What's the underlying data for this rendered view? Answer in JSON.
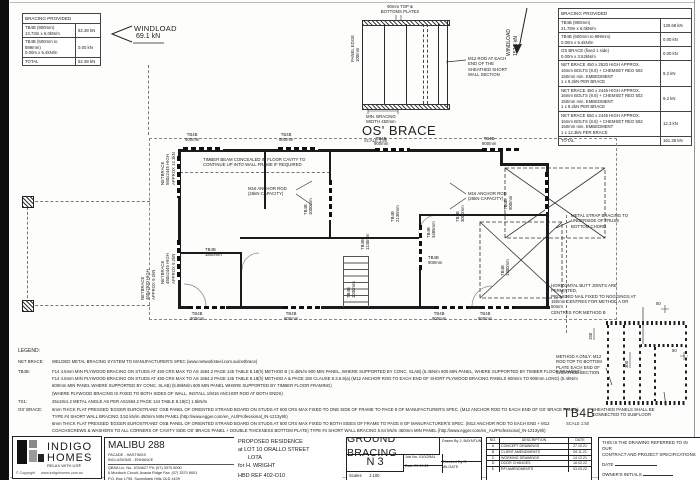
{
  "sheet": {
    "windload_left": {
      "label": "WINDLOAD",
      "value": "69.1 kN"
    },
    "windload_right": {
      "label": "WINDLOAD",
      "value": "157.3 kN"
    }
  },
  "table_left": {
    "header": "BRACING PROVIDED",
    "rows": [
      {
        "desc": "TB4B (900mm)\n13.73m x 6.0kN/m",
        "value": "82.38 kN"
      },
      {
        "desc": "TB4B (600mm to 899mm)\n0.00m x 5.4kN/m",
        "value": "0.00 kN"
      }
    ],
    "total_label": "TOTAL",
    "total_value": "82.38 kN"
  },
  "table_right": {
    "header": "BRACING PROVIDED",
    "rows": [
      {
        "desc": "TB4B (900mm)\n21.78m x 6.0kN/m",
        "value": "130.68 kN"
      },
      {
        "desc": "TB4B (600mm to 899mm)\n0.00m x 5.4kN/m",
        "value": "0.00 kN"
      },
      {
        "desc": "OS BRACE (fixed 1 side)\n0.00m x 3.52kN/m",
        "value": "0.00 kN"
      },
      {
        "desc": "NET BRACE 450 x 2520 HIGH APPROX.\n16mm BOLTS (8.8) + CHEMSET REO 502\n150mm min. EMBEDMENT\n1 x 9.2kN PER BRACE",
        "value": "9.2 kN"
      },
      {
        "desc": "NET BRACE 450 x 2445 HIGH APPROX.\n16mm BOLTS (8.8) + CHEMSET REO 502\n150mm min. EMBEDMENT\n1 x 9.2kN PER BRACE",
        "value": "9.2 kN"
      },
      {
        "desc": "NET BRACE 550 x 2445 HIGH APPROX.\n16mm BOLTS (8.8) + CHEMSET REO 502\n150mm min. EMBEDMENT\n1 x 12.3kN PER BRACE",
        "value": "12.3 kN"
      }
    ],
    "total_label": "TOTAL",
    "total_value": "161.38 kN"
  },
  "os_detail": {
    "title": "OS' BRACE",
    "scale": "SCALE 1:50",
    "top_label": "90mm TOP &\nBOTTOMS PLATES",
    "left_label": "PANEL EDGE\n100mm",
    "right_label": "M12 ROD AT EACH\nEND OF THE\nSHEATHED SHORT\nWALL SECTION",
    "bottom_label": "MIN. BRACING\nWIDTH 450mm"
  },
  "tb4b_detail": {
    "title": "TB4B",
    "scale": "SCALE 1:50",
    "note_method": "METHOD A ONLY: M12\nROD TOP TO BOTTOM\nPLATE EACH END OF\nSHEATHED SECTION",
    "note_subfloor": "SHEATHED PANELS SHALL BE\nCONNECTED TO SUBFLOOR",
    "dims": {
      "d50a": "50",
      "d150": "150",
      "d300": "300",
      "d50b": "50"
    }
  },
  "plan": {
    "labels": [
      {
        "t": "TB4B\n900mm"
      },
      {
        "t": "TB4B\n900mm"
      },
      {
        "t": "TB4B\n900mm"
      },
      {
        "t": "TB4B\n900mm"
      },
      {
        "t": "TB4B\n900mm"
      },
      {
        "t": "TB4B\n900mm"
      },
      {
        "t": "TB4B\n900mm"
      },
      {
        "t": "TB4B\n900mm"
      },
      {
        "t": "TIMBER BEAM CONCEALED IN FLOOR CAVITY TO\nCONTINUE UP INTO WALL FRAME IF REQUIRED"
      },
      {
        "t": "M16 ANCHOR ROD\n(25kN CAPACITY)"
      },
      {
        "t": "M16 ANCHOR ROD\n(25kN CAPACITY)"
      },
      {
        "t": "NETBRACE\n550x2445 HIGH\nAPPROX 12.3kN"
      },
      {
        "t": "NETBRACE\n450x2445 HIGH\nAPPROX 9.2kN"
      },
      {
        "t": "NETBRACE\n450x2520 HIGH\nAPPROX 9.2kN"
      },
      {
        "t": "METAL STRAP BRACING TO\nUNDERSIDE OF TRUSS\nBOTTOM CHORD"
      },
      {
        "t": "HORIZONTAL BUTT JOINTS ARE PERMITTED,\nPROVIDED NAIL FIXED TO NOGGINGS AT\n150mm CENTRES FOR METHOD A OR 50mm\nCENTRES FOR METHOD B"
      },
      {
        "t": "TB4B\n1000mm"
      },
      {
        "t": "TB4B\n2130mm"
      },
      {
        "t": "TB4B\n3485mm"
      },
      {
        "t": "TB4B\n3000mm"
      },
      {
        "t": "TB4B\n900mm"
      },
      {
        "t": "TB4B\n1800mm"
      },
      {
        "t": "TB4B\n1030mm"
      },
      {
        "t": "TB4B\n1130mm"
      },
      {
        "t": "TB4B\n1300mm"
      },
      {
        "t": "TB4B\n900mm"
      }
    ]
  },
  "legend": {
    "title": "LEGEND:",
    "net_label": "NET BRACE:",
    "net_text": "WELDED METAL BRACING SYSTEM TO MANUFACTURER'S SPEC (www.networksteel.com.au/netbrace)",
    "tb4b_label": "TB4B:",
    "tb4b_line1": "F14 4.5mm MIN PLYWOOD BRACING ON STUDS AT 450 CRS MAX TO AS 1684.2 PAGE 145 TABLE 8.18(h) METHOD B ( 5.4kN/m 900 MIN PANEL, WHERE SUPPORTED BY CONC. SLAB) (5.4kN/m 900 MIN PANEL, WHERE SUPPORTED BY TIMBER FLOOR FRAMING)",
    "tb4b_line2": "F14 4.5mm MIN PLYWOOD BRACING ON STUDS AT 450 CRS MAX TO AS 1684.2 PAGE 145 TABLE 8.18(h) METHOD A & PAGE 150 CLAUSE 8.3.6.9(a) (M12 ANCHOR ROD TO EACH END OF SHORT PLYWOOD BRACING PANELS 600mm TO 900mm LONG) (5.4kN/m",
    "tb4b_line3": "600mm MIN PANEL WHERE SUPPORTED BY CONC. SLAB) (5.88kN/m 600 MIN PANEL WHERE SUPPORTED BY TIMBER FLOOR FRAMING)",
    "tb4b_line4": "(WHERE PLYWOOD BRACING IS FIXED TO BOTH SIDES OF WALL, INSTALL 1/M16 ANCHOR ROD AT BOTH ENDS)",
    "ts1_label": "TS1:",
    "ts1_text": "25x18x1.2 METAL ANGLE AS PER AS1684.2 PAGE 144 TABLE 8.18(C) 1.5kN/m",
    "os_label": "OS' BRACE:",
    "os_line1": "6mm THICK FLAT PRESSED 'EGGER EUROSTRAND' OSB PANEL OF ORIENTED STRAND BOARD ON STUDS AT 600 CRS MAX FIXED TO ONE SIDE OF FRAME TO PAGE 8 OF MANUFACTURER'S SPEC. (M12 ANCHOR ROD TO EACH END OF OS' BRACE PANEL)",
    "os_line2": "TYPE #4 SHORT WALL BRACING 3.52 kN/m 450mm MIN PANEL (http://www.egger.com/en_AU/Professional_/N-1213y9h)",
    "os_line3": "6mm THICK FLAT PRESSED 'EGGER EUROSTRAND' OSB PANEL OF ORIENTED STRAND BOARD ON STUDS AT 600 CRS MAX FIXED TO BOTH SIDES OF FRAME TO PAGE 8 OF MANUFACTURER'S SPEC. (M12 ANCHOR ROD TO EACH END + M12",
    "os_line4": "COACHSCREWS & WASHERS TO ALL CORNERS OF CAVITY SIDE OS' BRACE PANEL + DOUBLE THICKNESS BOTTOM PLATE) TYPE #4 SHORT WALL BRACING 5.64 kN/m 450mm MIN PANEL (http://www.egger.com/en_AU/Professional_/N-1213y9h)"
  },
  "titleblock": {
    "logo": {
      "name_line1": "INDIGO",
      "name_line2": "HOMES",
      "tagline": "RELAX WITH US®",
      "copyright": "© Copyright",
      "website": "www.indigohomes.com.au"
    },
    "brand": {
      "title": "MALIBU 288",
      "facade": "FACADE - HASTINGS",
      "inclusions": "INCLUSIONS - ENHANCE",
      "licence": "QBSA Lic. No. 1034627 Ph: (07) 3370 8000",
      "address1": "6 Murdoch Circuit, Acacia Ridge Fax: (07) 3370 8001",
      "address2": "P.O. Box 1795, Sunnybank Hills QLD 4109"
    },
    "project": {
      "line1": "PROPOSED RESIDENCE",
      "line2": "at  LOT 10 ORALLO STREET",
      "line3": "LOTA",
      "line4": "for H. WRIGHT",
      "line5": "HBD REF 402-O10"
    },
    "drawing": {
      "title": "GROUND BRACING",
      "sheet": "N 3",
      "job_label": "Job No.",
      "job": "010ORAL",
      "date_label": "Date",
      "date": "20.10.21",
      "drawn_label": "Drawn By",
      "drawn": "J. BAYNTUN",
      "checked_label": "Checked By",
      "checked": "R. MILGATE",
      "scales_label": "Scales",
      "scales": "1:100"
    },
    "revisions": {
      "headers": [
        "NO.",
        "DESCRIPTION",
        "DATE"
      ],
      "rows": [
        [
          "A",
          "CONCEPT DRAWINGS",
          "27.10.21"
        ],
        [
          "B",
          "CLIENT AMENDMENTS",
          "09.11.21"
        ],
        [
          "C",
          "WORKING DRAWINGS",
          "14.12.21"
        ],
        [
          "D",
          "DOOR CHANGES",
          "18.02.22"
        ],
        [
          "E",
          "RFI AMENDMENTS",
          "03.03.22"
        ]
      ]
    },
    "contract": {
      "line1": "THIS IS THE DRAWING REFERRED TO IN OUR",
      "line2": "CONTRACT AND PROJECT SPECIFICATIONS",
      "date_label": "DATE",
      "owner_label": "OWNER'S INITIALS",
      "builder_label": "BUILDER'S INITIALS"
    }
  }
}
